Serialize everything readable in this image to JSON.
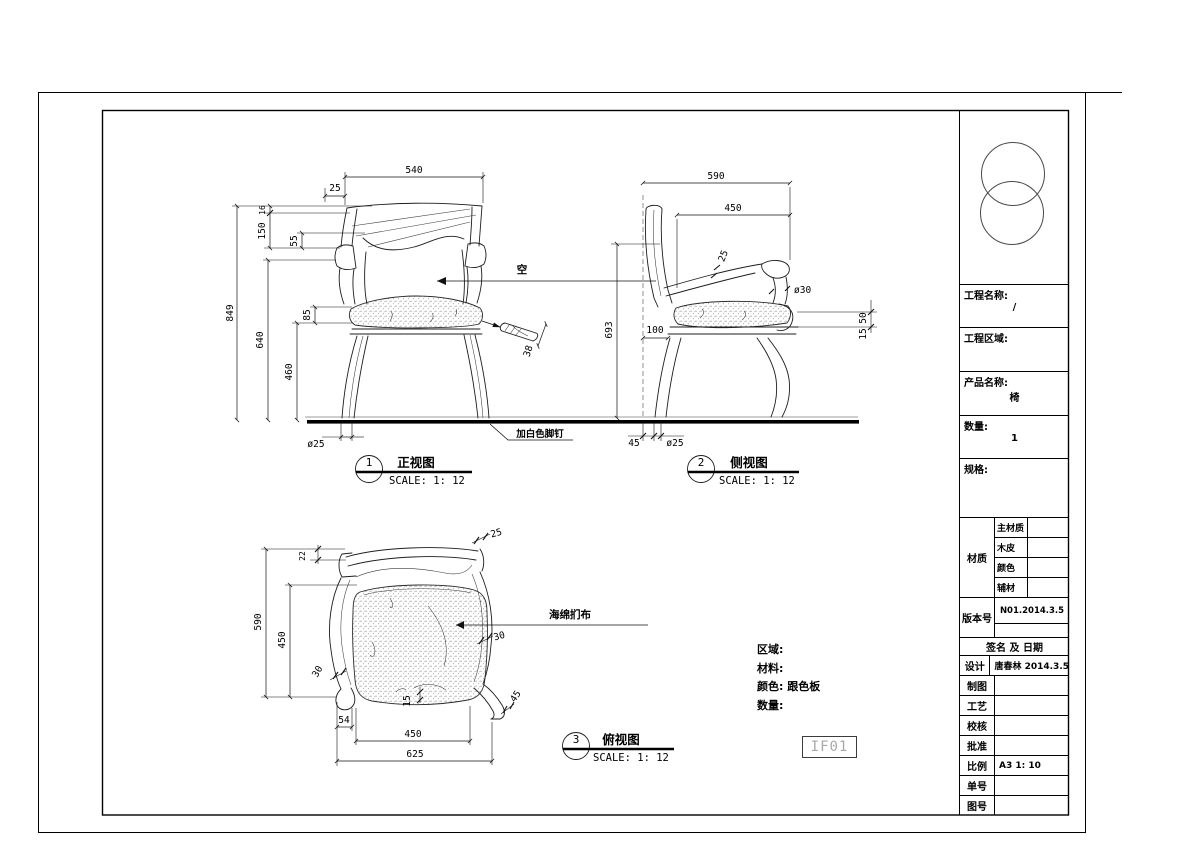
{
  "front_view": {
    "badge": "1",
    "title": "正视图",
    "scale": "SCALE: 1: 12",
    "dim_540": "540",
    "dim_25": "25",
    "dim_16": "16",
    "dim_150": "150",
    "dim_55": "55",
    "dim_849": "849",
    "dim_640": "640",
    "dim_460": "460",
    "dim_85": "85",
    "dim_38": "38",
    "dim_leg": "ø25",
    "label_hollow": "空",
    "label_footnail": "加白色脚钉"
  },
  "side_view": {
    "badge": "2",
    "title": "侧视图",
    "scale": "SCALE: 1: 12",
    "dim_590": "590",
    "dim_450": "450",
    "dim_25": "25",
    "dim_30": "ø30",
    "dim_693": "693",
    "dim_100": "100",
    "dim_50": "50",
    "dim_15": "15",
    "dim_45": "45",
    "dim_leg": "ø25"
  },
  "top_view": {
    "badge": "3",
    "title": "俯视图",
    "scale": "SCALE: 1: 12",
    "dim_22": "22",
    "dim_25": "25",
    "dim_590": "590",
    "dim_450_left": "450",
    "dim_30_left": "30",
    "dim_30_right": "30",
    "dim_45": "45",
    "dim_15": "15",
    "dim_54": "54",
    "dim_450_bottom": "450",
    "dim_625": "625",
    "label_cushion": "海绵扪布"
  },
  "notes": {
    "area": "区域:",
    "material": "材料:",
    "color": "颜色: 跟色板",
    "quantity": "数量:"
  },
  "code_box": "IF01",
  "title_block": {
    "project_name_label": "工程名称:",
    "project_name_value": "/",
    "project_area_label": "工程区域:",
    "project_area_value": "",
    "product_name_label": "产品名称:",
    "product_name_value": "椅",
    "quantity_label": "数量:",
    "quantity_value": "1",
    "spec_label": "规格:",
    "spec_value": "",
    "material_label": "材质",
    "material_rows": [
      {
        "label": "主材质",
        "value": ""
      },
      {
        "label": "木皮",
        "value": ""
      },
      {
        "label": "颜色",
        "value": ""
      },
      {
        "label": "辅材",
        "value": ""
      }
    ],
    "version_label": "版本号",
    "version_value": "N01.2014.3.5",
    "sign_header": "签名 及 日期",
    "sign_rows": [
      {
        "label": "设计",
        "value": "唐春林 2014.3.5"
      },
      {
        "label": "制图",
        "value": ""
      },
      {
        "label": "工艺",
        "value": ""
      },
      {
        "label": "校核",
        "value": ""
      },
      {
        "label": "批准",
        "value": ""
      },
      {
        "label": "比例",
        "value": "A3 1: 10"
      },
      {
        "label": "单号",
        "value": ""
      },
      {
        "label": "图号",
        "value": ""
      }
    ]
  }
}
